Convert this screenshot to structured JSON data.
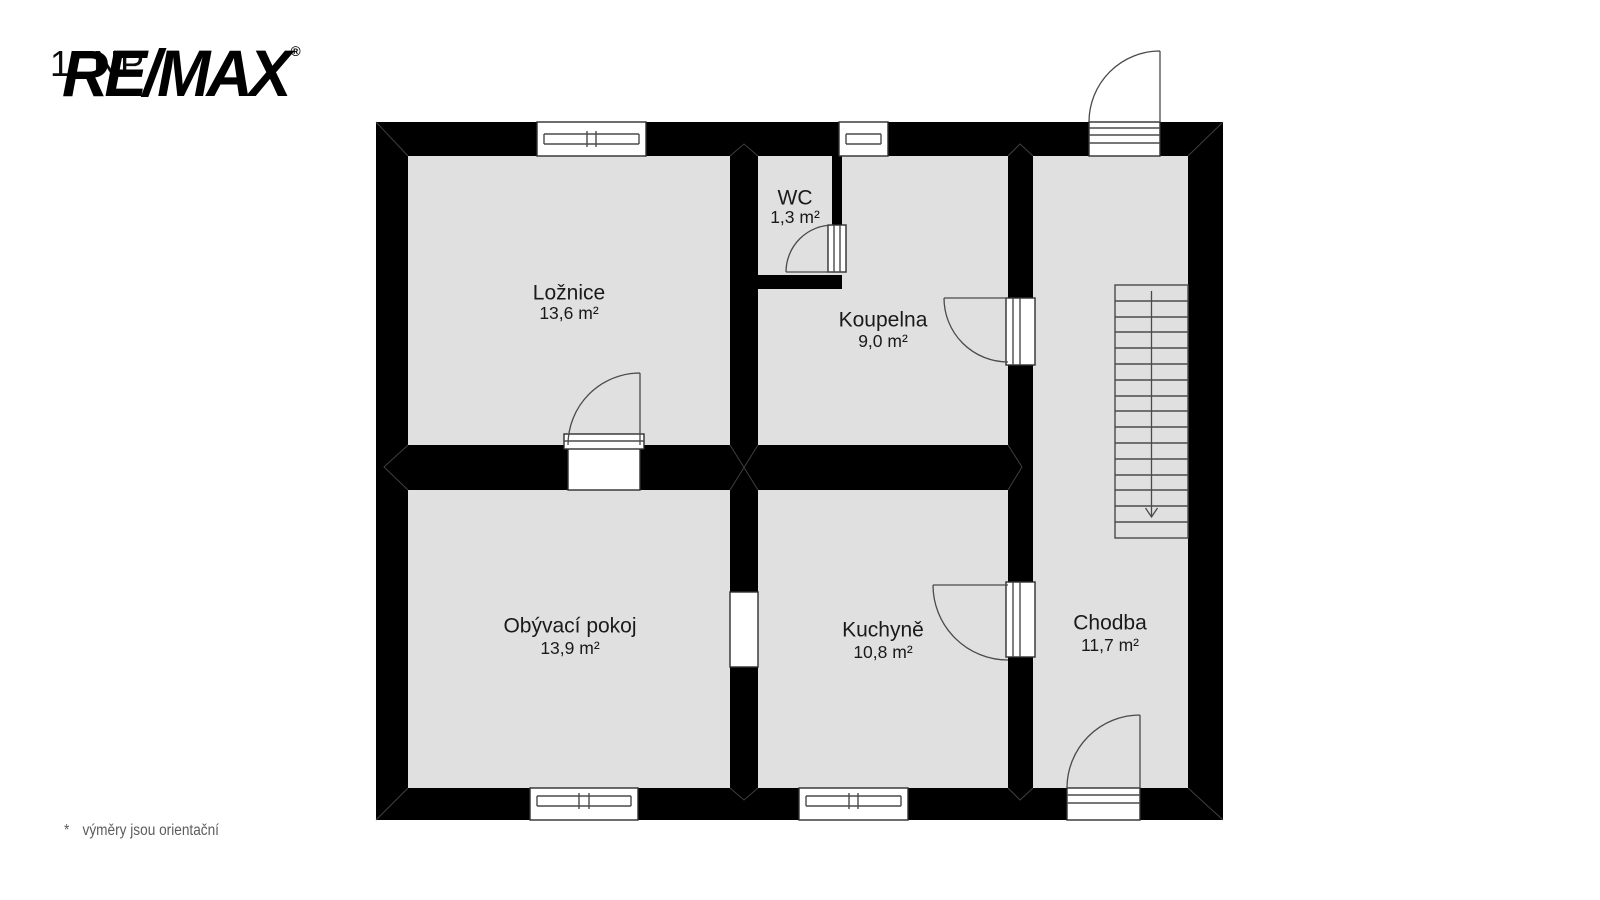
{
  "header": {
    "floor_label": "1. NP",
    "brand": "RE/MAX",
    "registered_mark": "®"
  },
  "rooms": [
    {
      "name": "Ložnice",
      "area": "13,6 m²"
    },
    {
      "name": "WC",
      "area": "1,3 m²"
    },
    {
      "name": "Koupelna",
      "area": "9,0 m²"
    },
    {
      "name": "Obývací pokoj",
      "area": "13,9 m²"
    },
    {
      "name": "Kuchyně",
      "area": "10,8 m²"
    },
    {
      "name": "Chodba",
      "area": "11,7 m²"
    }
  ],
  "footnote": {
    "marker": "*",
    "text": "výměry jsou orientační"
  },
  "colors": {
    "background": "#ffffff",
    "wall": "#000000",
    "floor": "#e0e0e0",
    "line": "#4a4a4a",
    "label_text": "#1a1a1a",
    "footnote_text": "#5c5c5c"
  }
}
